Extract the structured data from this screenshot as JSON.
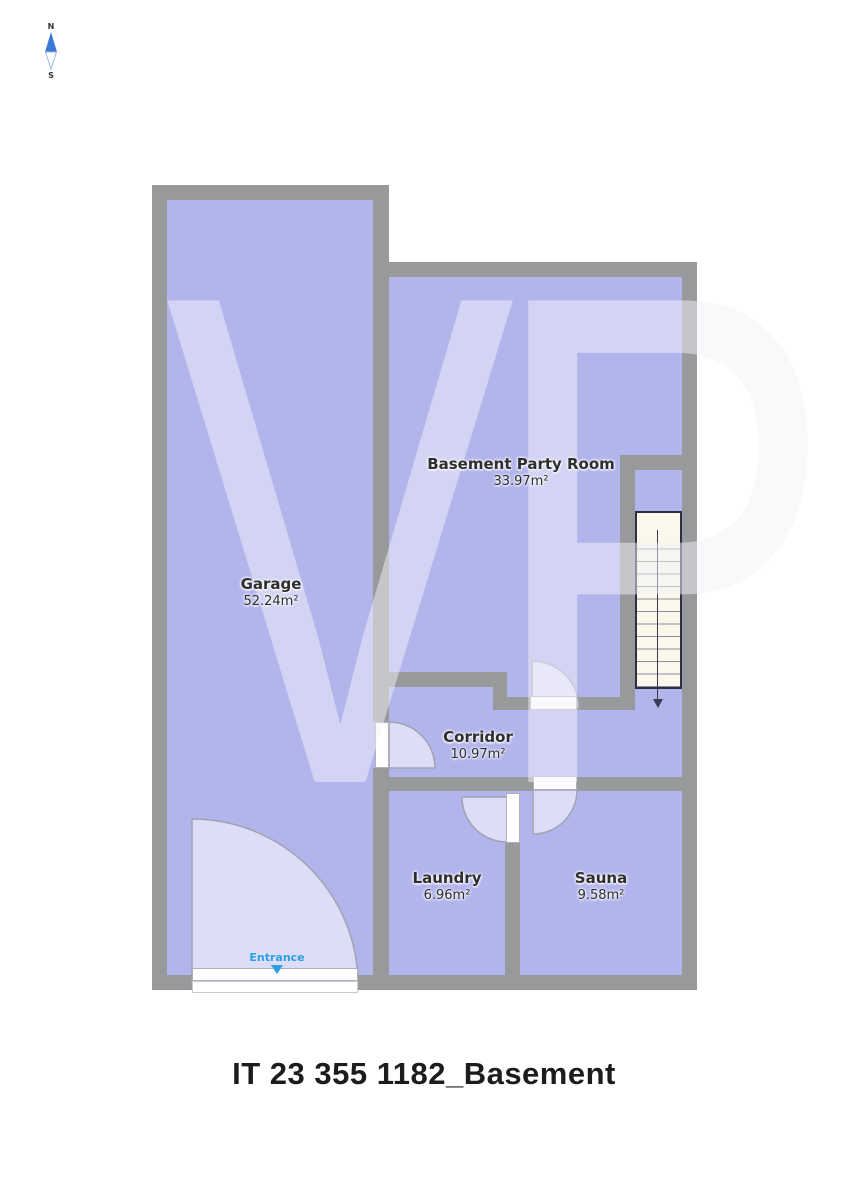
{
  "title": "IT 23 355 1182_Basement",
  "compass": {
    "north_label": "N",
    "south_label": "S"
  },
  "floorplan": {
    "watermark": "VP",
    "entrance_label": "Entrance",
    "rooms": [
      {
        "name": "Garage",
        "area": "52.24m²"
      },
      {
        "name": "Basement Party Room",
        "area": "33.97m²"
      },
      {
        "name": "Corridor",
        "area": "10.97m²"
      },
      {
        "name": "Laundry",
        "area": "6.96m²"
      },
      {
        "name": "Sauna",
        "area": "9.58m²"
      }
    ],
    "stairs": {
      "direction": "down"
    }
  },
  "colors": {
    "room_fill": "#b2b4ec",
    "wall": "#98999a",
    "stairs_fill": "#fbf7ea",
    "entrance_text": "#2d9fe3",
    "compass_north": "#3c78d8",
    "watermark_color": "rgba(243,243,250,0.5)"
  }
}
